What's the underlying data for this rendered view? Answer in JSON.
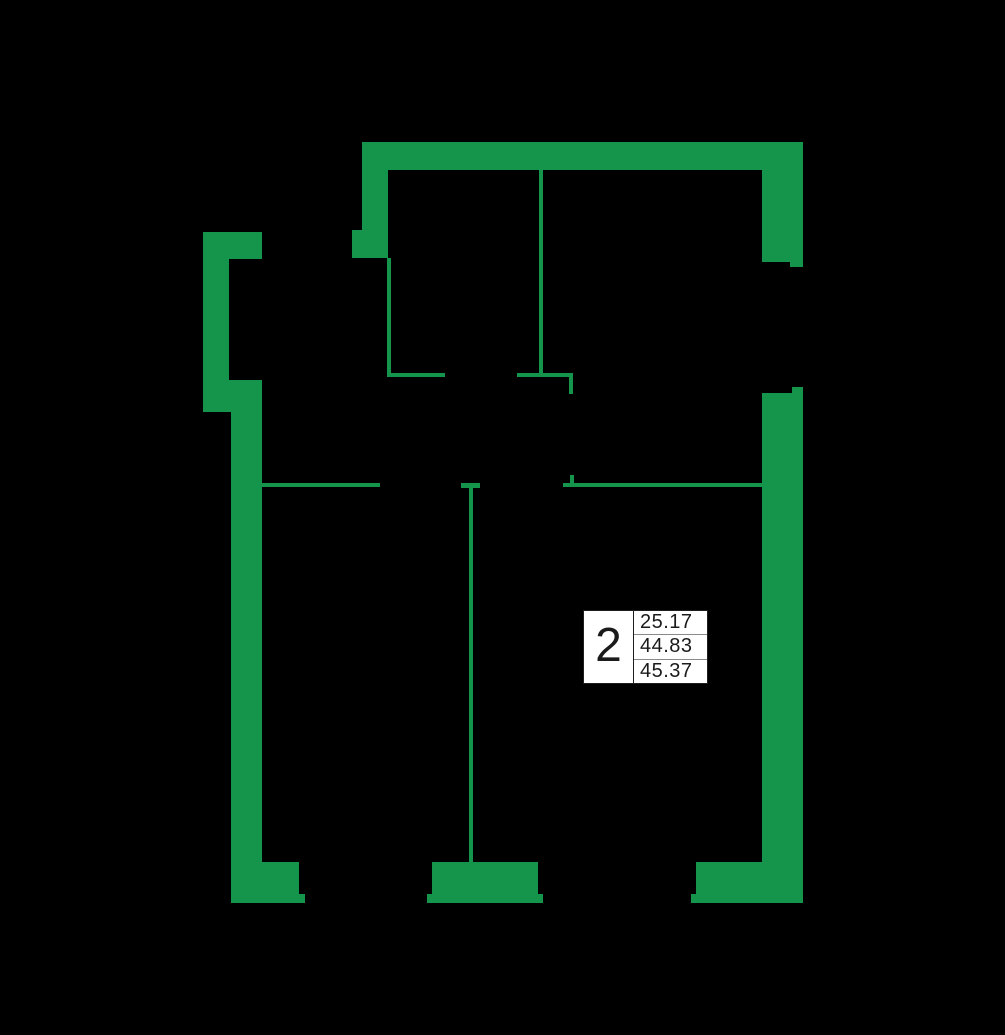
{
  "colors": {
    "background": "#000000",
    "wall": "#14954B",
    "label_background": "#FFFFFF",
    "label_border": "#1E1E1E",
    "label_divider": "#8A8A8A",
    "label_text": "#1B1B1B"
  },
  "unit_label": {
    "number": "2",
    "areas": [
      "25.17",
      "44.83",
      "45.37"
    ]
  },
  "floorplan": {
    "canvas": {
      "width": 1005,
      "height": 1035
    },
    "wall_segments": [
      {
        "name": "top-outer",
        "x": 362,
        "y": 142,
        "w": 441,
        "h": 28
      },
      {
        "name": "top-left-outer",
        "x": 362,
        "y": 142,
        "w": 26,
        "h": 116
      },
      {
        "name": "top-left-pier",
        "x": 352,
        "y": 230,
        "w": 36,
        "h": 28
      },
      {
        "name": "right-upper-outer",
        "x": 762,
        "y": 142,
        "w": 41,
        "h": 120
      },
      {
        "name": "right-upper-window-step",
        "x": 790,
        "y": 262,
        "w": 13,
        "h": 5
      },
      {
        "name": "right-lower-window-step",
        "x": 792,
        "y": 387,
        "w": 11,
        "h": 6
      },
      {
        "name": "right-lower-outer",
        "x": 762,
        "y": 393,
        "w": 41,
        "h": 510
      },
      {
        "name": "balcony-top-pier",
        "x": 203,
        "y": 232,
        "w": 59,
        "h": 27
      },
      {
        "name": "balcony-outer",
        "x": 203,
        "y": 259,
        "w": 26,
        "h": 121
      },
      {
        "name": "balcony-bottom-pier",
        "x": 203,
        "y": 380,
        "w": 59,
        "h": 32
      },
      {
        "name": "left-outer",
        "x": 231,
        "y": 412,
        "w": 31,
        "h": 491
      },
      {
        "name": "bottom-left-block",
        "x": 262,
        "y": 862,
        "w": 37,
        "h": 32
      },
      {
        "name": "bottom-left-foot",
        "x": 262,
        "y": 894,
        "w": 43,
        "h": 9
      },
      {
        "name": "bottom-middle-block",
        "x": 432,
        "y": 862,
        "w": 106,
        "h": 33
      },
      {
        "name": "bottom-middle-foot",
        "x": 427,
        "y": 894,
        "w": 116,
        "h": 9
      },
      {
        "name": "bottom-right-foot",
        "x": 691,
        "y": 894,
        "w": 5,
        "h": 9
      },
      {
        "name": "bottom-right-block",
        "x": 696,
        "y": 862,
        "w": 107,
        "h": 41
      },
      {
        "name": "partition-left-vertical",
        "x": 387,
        "y": 258,
        "w": 4,
        "h": 119
      },
      {
        "name": "partition-left-horizontal",
        "x": 387,
        "y": 373,
        "w": 58,
        "h": 4
      },
      {
        "name": "partition-center-vertical",
        "x": 539,
        "y": 169,
        "w": 4,
        "h": 208
      },
      {
        "name": "partition-center-horizontal",
        "x": 517,
        "y": 373,
        "w": 56,
        "h": 4
      },
      {
        "name": "partition-door-stub",
        "x": 569,
        "y": 377,
        "w": 4,
        "h": 17
      },
      {
        "name": "partition-door-jamb",
        "x": 570,
        "y": 475,
        "w": 4,
        "h": 9
      },
      {
        "name": "partition-right-horizontal",
        "x": 563,
        "y": 483,
        "w": 199,
        "h": 4
      },
      {
        "name": "partition-mid-cap",
        "x": 461,
        "y": 483,
        "w": 19,
        "h": 5
      },
      {
        "name": "partition-mid-vertical",
        "x": 469,
        "y": 487,
        "w": 4,
        "h": 375
      },
      {
        "name": "partition-bottomleft-horizontal",
        "x": 262,
        "y": 483,
        "w": 118,
        "h": 4
      }
    ]
  }
}
